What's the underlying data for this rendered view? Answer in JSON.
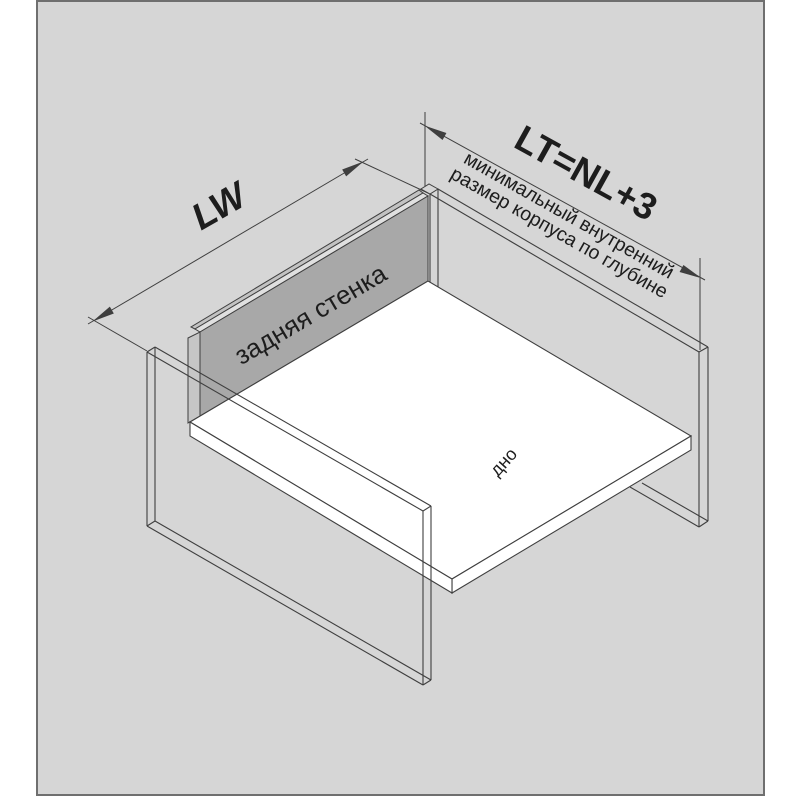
{
  "diagram": {
    "title_hint": "drawer assembly diagram",
    "labels": {
      "lw": "LW",
      "lt": "LT=NL+3",
      "lt_note_line1": "минимальный  внутренний",
      "lt_note_line2": "размер корпуса по глубине",
      "back_panel": "задняя стенка",
      "bottom_panel": "дно"
    },
    "colors": {
      "page_bg": "#ffffff",
      "canvas_bg": "#d6d6d6",
      "canvas_border": "#6f6f6f",
      "line": "#3f3f3f",
      "text": "#1d1d1d",
      "back_panel_face": "#a8a8a8",
      "back_panel_top_band1": "#e0e0e0",
      "back_panel_top_band2": "#c2c2c2",
      "back_panel_end": "#c6c6c6",
      "bottom_panel_face": "#ffffff"
    }
  }
}
